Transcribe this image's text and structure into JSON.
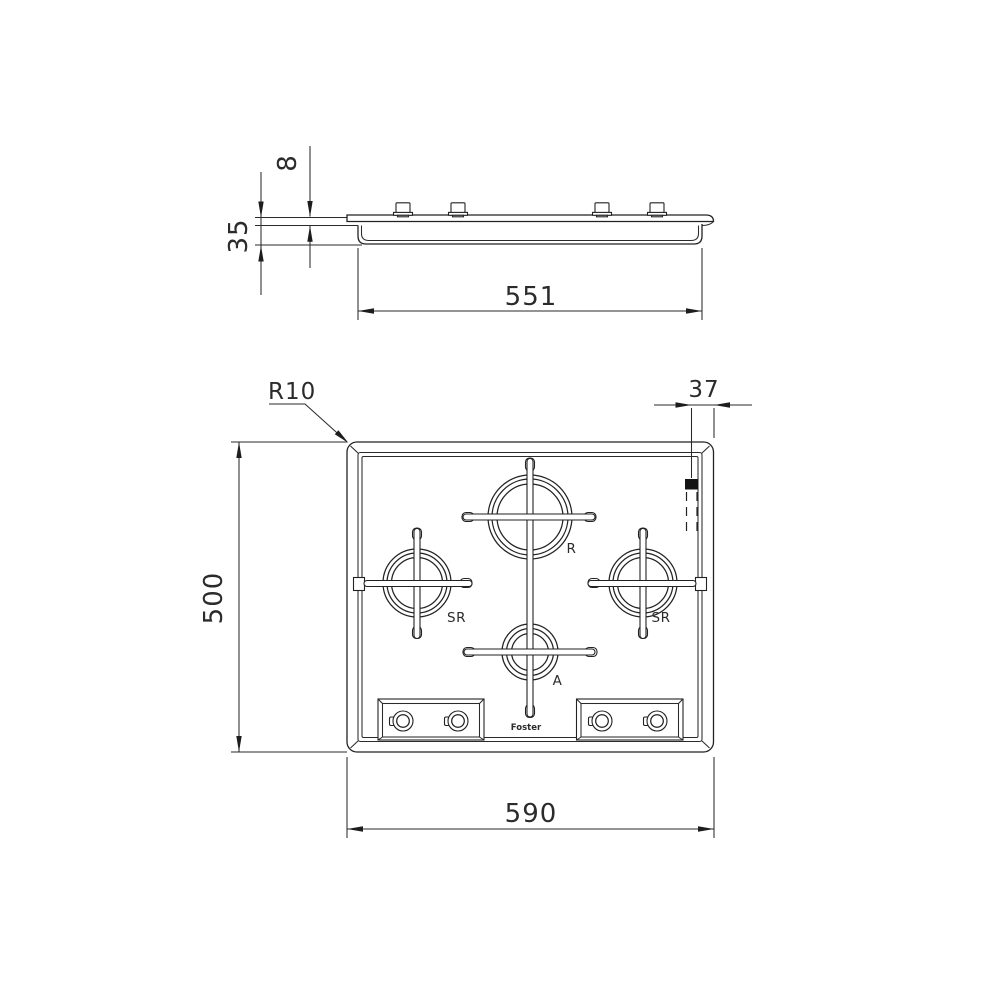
{
  "drawing": {
    "type": "installation-drawing-gas-hob",
    "side_view": {
      "dims": {
        "height_above_worktop": "8",
        "recess_depth": "35",
        "cutout_width": "551"
      }
    },
    "plan_view": {
      "dims": {
        "corner_radius": "R10",
        "connection_offset": "37",
        "depth": "500",
        "width": "590"
      },
      "burners": [
        {
          "id": "rapid",
          "label": "R"
        },
        {
          "id": "semi-rapid-left",
          "label": "SR"
        },
        {
          "id": "semi-rapid-right",
          "label": "SR"
        },
        {
          "id": "auxiliary",
          "label": "A"
        }
      ],
      "logo": "Foster"
    },
    "colors": {
      "line": "#222222",
      "background": "#ffffff",
      "ignition_marker": "#141414"
    }
  }
}
